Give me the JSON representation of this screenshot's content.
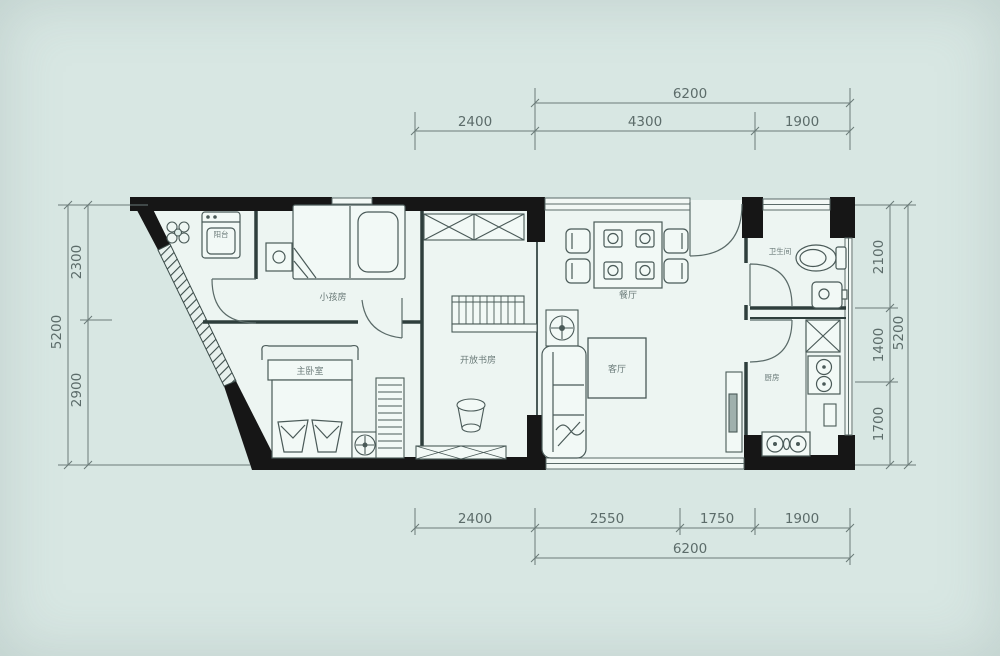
{
  "plan": {
    "type": "apartment-floor-plan",
    "rooms": {
      "balcony": "阳台",
      "kids_room": "小孩房",
      "master_bedroom": "主卧室",
      "open_study": "开放书房",
      "dining_room": "餐厅",
      "living_room": "客厅",
      "bathroom": "卫生间",
      "kitchen": "厨房"
    },
    "dimensions": {
      "top": {
        "overall": "6200",
        "segments": [
          "2400",
          "4300",
          "1900"
        ]
      },
      "bottom": {
        "overall": "6200",
        "segments": [
          "2400",
          "2550",
          "1750",
          "1900"
        ]
      },
      "left": {
        "overall": "5200",
        "segments": [
          "2300",
          "2900"
        ]
      },
      "right": {
        "overall": "5200",
        "segments": [
          "2100",
          "1400",
          "1700"
        ]
      }
    },
    "colors": {
      "background": "#d8e7e3",
      "floor": "#edf5f2",
      "wall": "#161616",
      "line": "#4a5a58",
      "dim_line": "#6b7b79",
      "dim_text": "#5c6c6a"
    }
  }
}
